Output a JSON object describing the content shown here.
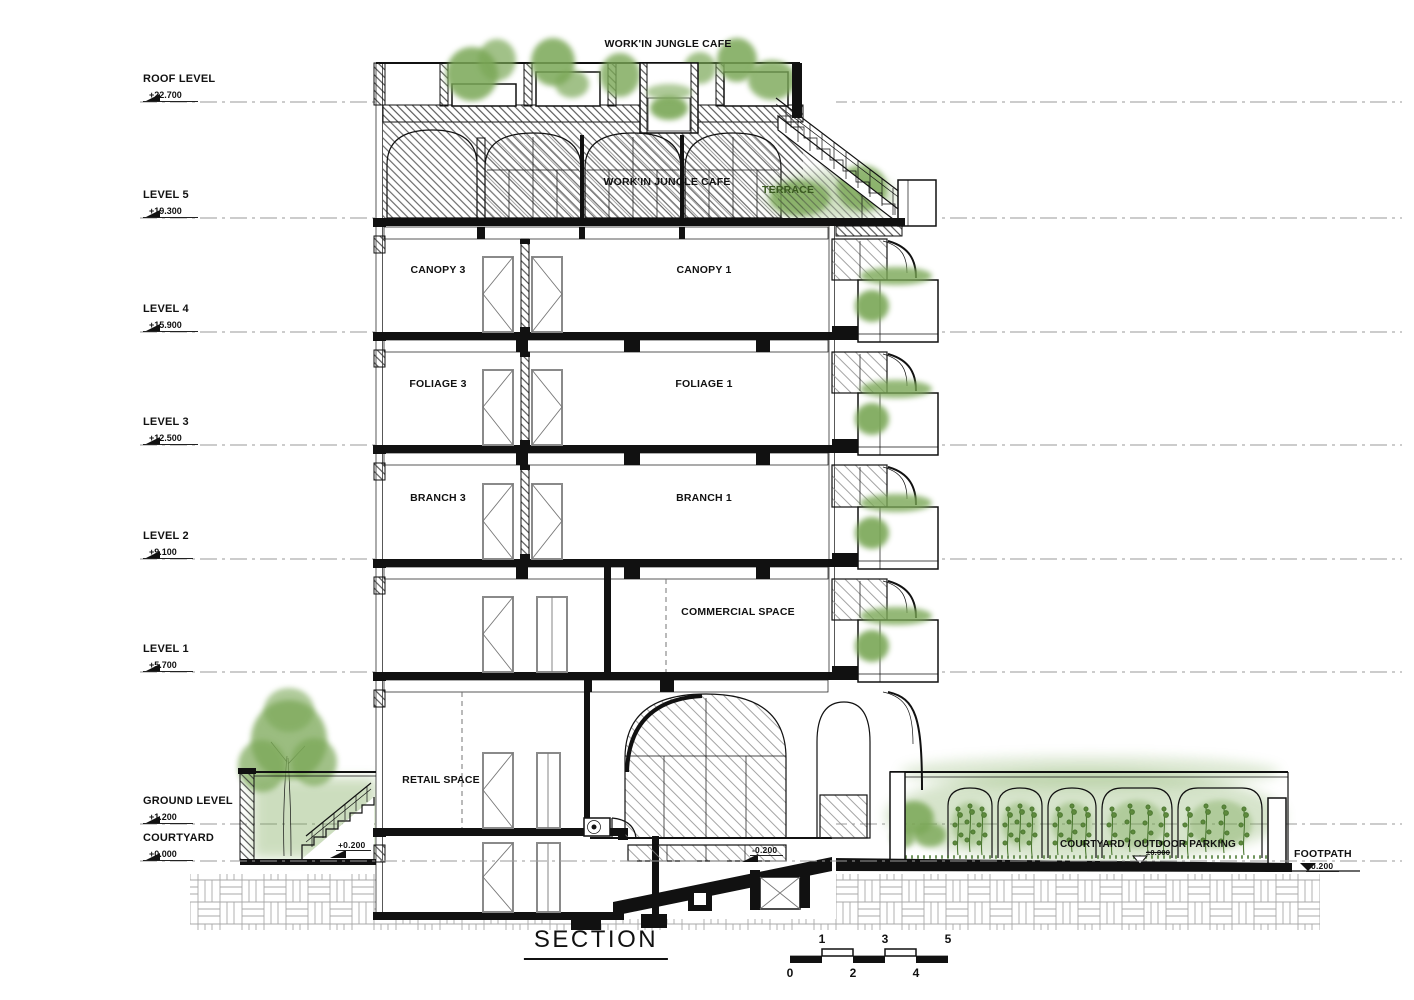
{
  "title": {
    "text": "SECTION"
  },
  "levels": [
    {
      "name": "ROOF LEVEL",
      "elev": "+22.700"
    },
    {
      "name": "LEVEL 5",
      "elev": "+19.300"
    },
    {
      "name": "LEVEL 4",
      "elev": "+15.900"
    },
    {
      "name": "LEVEL 3",
      "elev": "+12.500"
    },
    {
      "name": "LEVEL 2",
      "elev": "+9.100"
    },
    {
      "name": "LEVEL 1",
      "elev": "+5.700"
    },
    {
      "name": "GROUND LEVEL",
      "elev": "+1.200"
    },
    {
      "name": "COURTYARD",
      "elev": "+0.000"
    }
  ],
  "rooms": {
    "cafe": "WORK'IN JUNGLE CAFE",
    "terrace": "TERRACE",
    "canopy3": "CANOPY 3",
    "canopy1": "CANOPY 1",
    "foliage3": "FOLIAGE 3",
    "foliage1": "FOLIAGE 1",
    "branch3": "BRANCH 3",
    "branch1": "BRANCH 1",
    "commercial": "COMMERCIAL SPACE",
    "retail": "RETAIL SPACE",
    "outdoor_parking": "COURTYARD / OUTDOOR PARKING",
    "footpath": "FOOTPATH"
  },
  "spot_elevations": {
    "courtyard_stair": "+0.200",
    "ramp": "-0.200",
    "parking": "±0.000",
    "footpath": "-0.200"
  },
  "scale_bar": {
    "top": [
      "1",
      "3",
      "5"
    ],
    "bottom": [
      "0",
      "2",
      "4"
    ]
  },
  "colors": {
    "line": "#111111",
    "foliage": "#7aa757",
    "foliage_dark": "#4e7a34"
  }
}
